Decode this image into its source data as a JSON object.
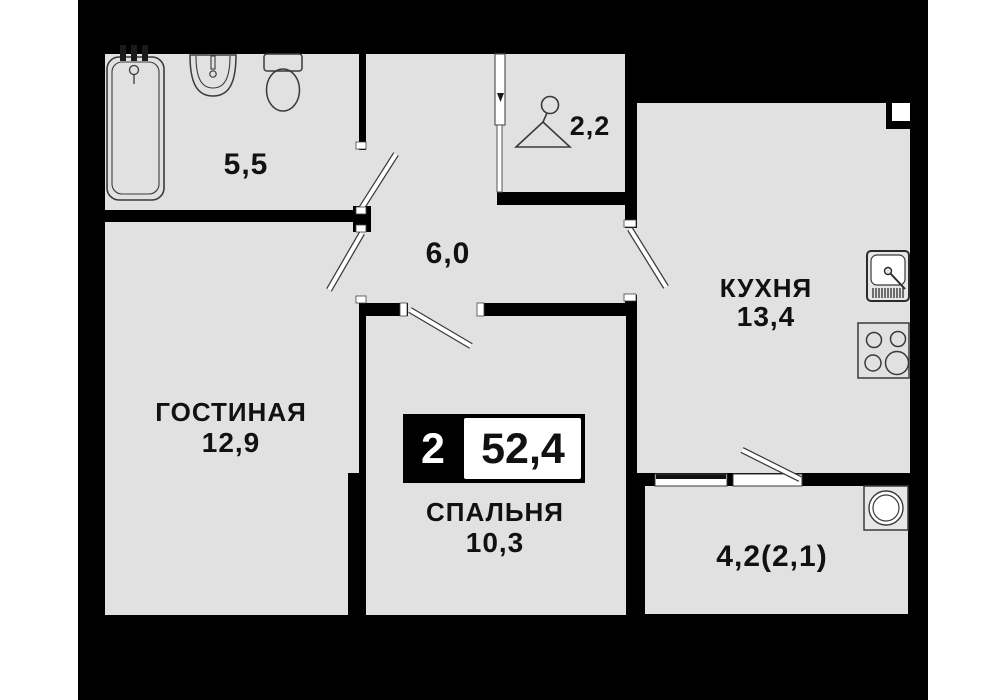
{
  "floorplan": {
    "badge": {
      "room_count": "2",
      "total_area": "52,4"
    },
    "rooms": {
      "bathroom": {
        "area": "5,5"
      },
      "wardrobe": {
        "area": "2,2"
      },
      "hallway": {
        "area": "6,0"
      },
      "living_room": {
        "name": "ГОСТИНАЯ",
        "area": "12,9"
      },
      "kitchen": {
        "name": "КУХНЯ",
        "area": "13,4"
      },
      "bedroom": {
        "name": "СПАЛЬНЯ",
        "area": "10,3"
      },
      "balcony": {
        "area": "4,2(2,1)"
      }
    },
    "icons": [
      "bathtub-icon",
      "bath-sink-icon",
      "toilet-icon",
      "hanger-icon",
      "kitchen-sink-icon",
      "stove-icon",
      "washing-machine-icon",
      "door-swing-icon",
      "sliding-door-icon",
      "window-icon"
    ],
    "colors": {
      "page_background": "#ffffff",
      "plan_background": "#000000",
      "floor": "#e1e1e1",
      "fixture_line": "#3a3a3a",
      "text": "#111111",
      "badge_black": "#000000",
      "badge_white": "#ffffff"
    }
  }
}
